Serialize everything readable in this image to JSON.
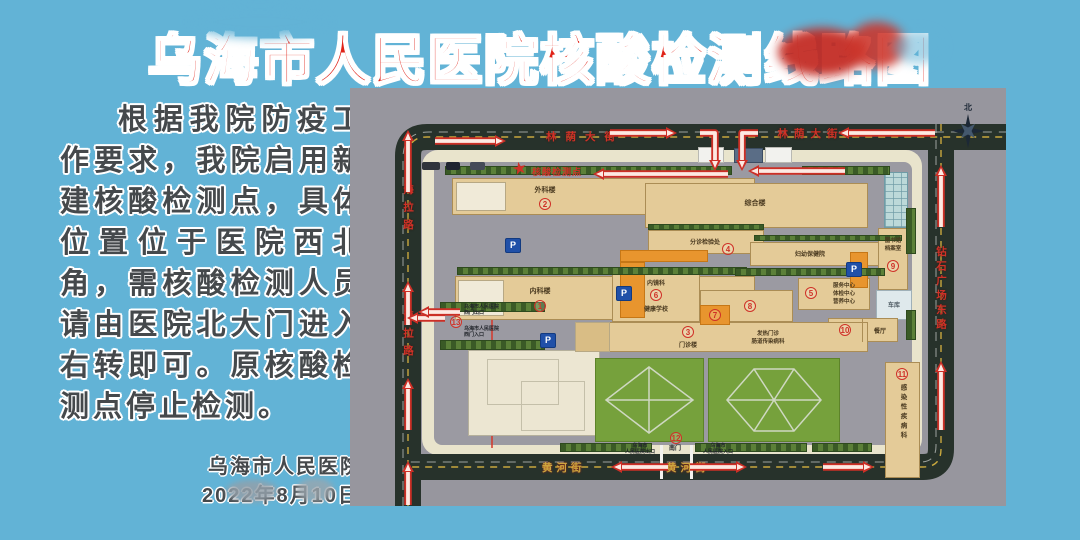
{
  "title": {
    "text": "乌海市人民医院核酸检测线路图"
  },
  "notice": {
    "lines": [
      "根据我院防疫工",
      "作要求，我院启用新",
      "建核酸检测点，具体",
      "位置位于医院西北",
      "角，需核酸检测人员",
      "请由医院北大门进入",
      "右转即可。原核酸检",
      "测点停止检测。"
    ]
  },
  "signature": {
    "org": "乌海市人民医院",
    "date": "2022年8月10日"
  },
  "map": {
    "streets": {
      "north": "林荫大街",
      "west": "海拉路",
      "east": "钻石广场东路",
      "south": "黄河街"
    },
    "compass_north": "北",
    "test_point_label": "核酸检测点",
    "parking_label": "P",
    "buildings": {
      "b1": {
        "num": "1",
        "label": "内科楼"
      },
      "b2": {
        "num": "2",
        "label": "外科楼"
      },
      "b3": {
        "num": "3",
        "label": "门诊楼"
      },
      "b4": {
        "num": "4",
        "label": "分诊检验处"
      },
      "b5": {
        "num": "5",
        "lines": [
          "服务中心",
          "体检中心",
          "营养中心"
        ]
      },
      "b6": {
        "num": "6",
        "top": "内镜科",
        "bottom": "健康学校"
      },
      "b7": {
        "num": "7"
      },
      "b8": {
        "num": "8"
      },
      "b9": {
        "num": "9",
        "lines": [
          "图书馆",
          "档案室"
        ]
      },
      "b10": {
        "num": "10",
        "label": "餐厅"
      },
      "b11": {
        "num": "11",
        "label": "感染性疾病科"
      },
      "zonghe": {
        "label": "综合楼"
      },
      "fuyou": {
        "label": "妇幼保健院"
      },
      "fever": {
        "lines": [
          "发热门诊",
          "肠道传染病科"
        ]
      },
      "garage": {
        "label": "车库"
      }
    },
    "gates": {
      "south": {
        "num": "12",
        "label": "南门",
        "exit": [
          "乌海市",
          "人民医院出口"
        ],
        "entry": [
          "乌海市",
          "人民医院入口"
        ]
      },
      "west": {
        "num": "13",
        "exit": [
          "乌海市人民医院",
          "西门出口"
        ],
        "entry": [
          "乌海市人民医院",
          "西门入口"
        ]
      }
    }
  }
}
